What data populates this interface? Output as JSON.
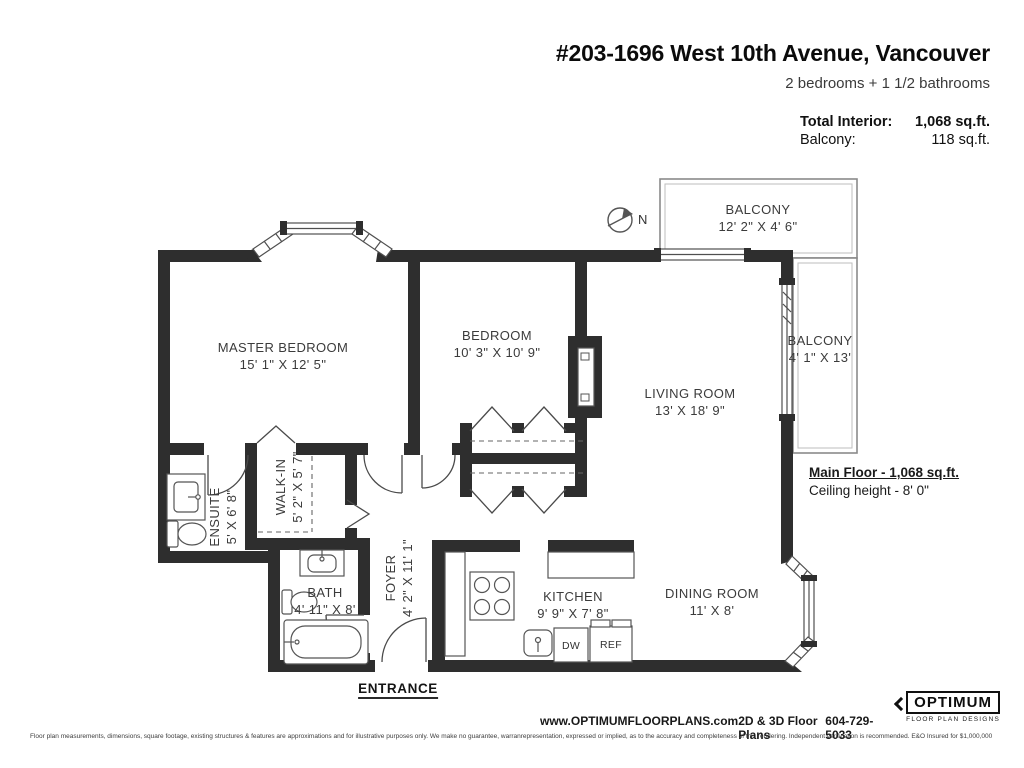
{
  "header": {
    "title": "#203-1696 West 10th Avenue, Vancouver",
    "subtitle": "2 bedrooms + 1 1/2 bathrooms",
    "total_interior_label": "Total Interior:",
    "total_interior_value": "1,068 sq.ft.",
    "balcony_label": "Balcony:",
    "balcony_value": "118 sq.ft."
  },
  "plan": {
    "north_label": "N",
    "rooms": {
      "balcony_top": {
        "name": "BALCONY",
        "dims": "12' 2\" X 4' 6\""
      },
      "balcony_right": {
        "name": "BALCONY",
        "dims": "4' 1\" X 13'"
      },
      "master": {
        "name": "MASTER BEDROOM",
        "dims": "15' 1\" X 12' 5\""
      },
      "bedroom": {
        "name": "BEDROOM",
        "dims": "10' 3\" X 10' 9\""
      },
      "living": {
        "name": "LIVING ROOM",
        "dims": "13' X 18' 9\""
      },
      "dining": {
        "name": "DINING ROOM",
        "dims": "11' X 8'"
      },
      "kitchen": {
        "name": "KITCHEN",
        "dims": "9' 9\" X 7' 8\""
      },
      "ensuite": {
        "name": "ENSUITE",
        "dims": "5' X 6' 8\""
      },
      "walkin": {
        "name": "WALK-IN",
        "dims": "5' 2\" X 5' 7\""
      },
      "bath": {
        "name": "BATH",
        "dims": "4' 11\" X 8'"
      },
      "foyer": {
        "name": "FOYER",
        "dims": "4' 2\" X 11' 1\""
      }
    },
    "appliances": {
      "dw": "DW",
      "ref": "REF"
    },
    "entrance_label": "ENTRANCE",
    "note_line1": "Main Floor - 1,068 sq.ft.",
    "note_line2": "Ceiling height - 8' 0\""
  },
  "footer": {
    "website": "www.OPTIMUMFLOORPLANS.com",
    "services": "2D & 3D Floor Plans",
    "phone": "604-729-5033",
    "disclaimer": "Floor plan measurements, dimensions, square footage, existing structures & features are approximations and for illustrative purposes only. We make no guarantee, warranrepresentation, expressed or implied, as to the accuracy and completeness of this rendering. Independent verification is recommended. E&O Insured for $1,000,000",
    "logo_text": "OPTIMUM",
    "logo_sub": "FLOOR PLAN DESIGNS"
  },
  "colors": {
    "wall": "#2e2e2e",
    "line": "#555555",
    "label_text": "#3b3b3b"
  }
}
